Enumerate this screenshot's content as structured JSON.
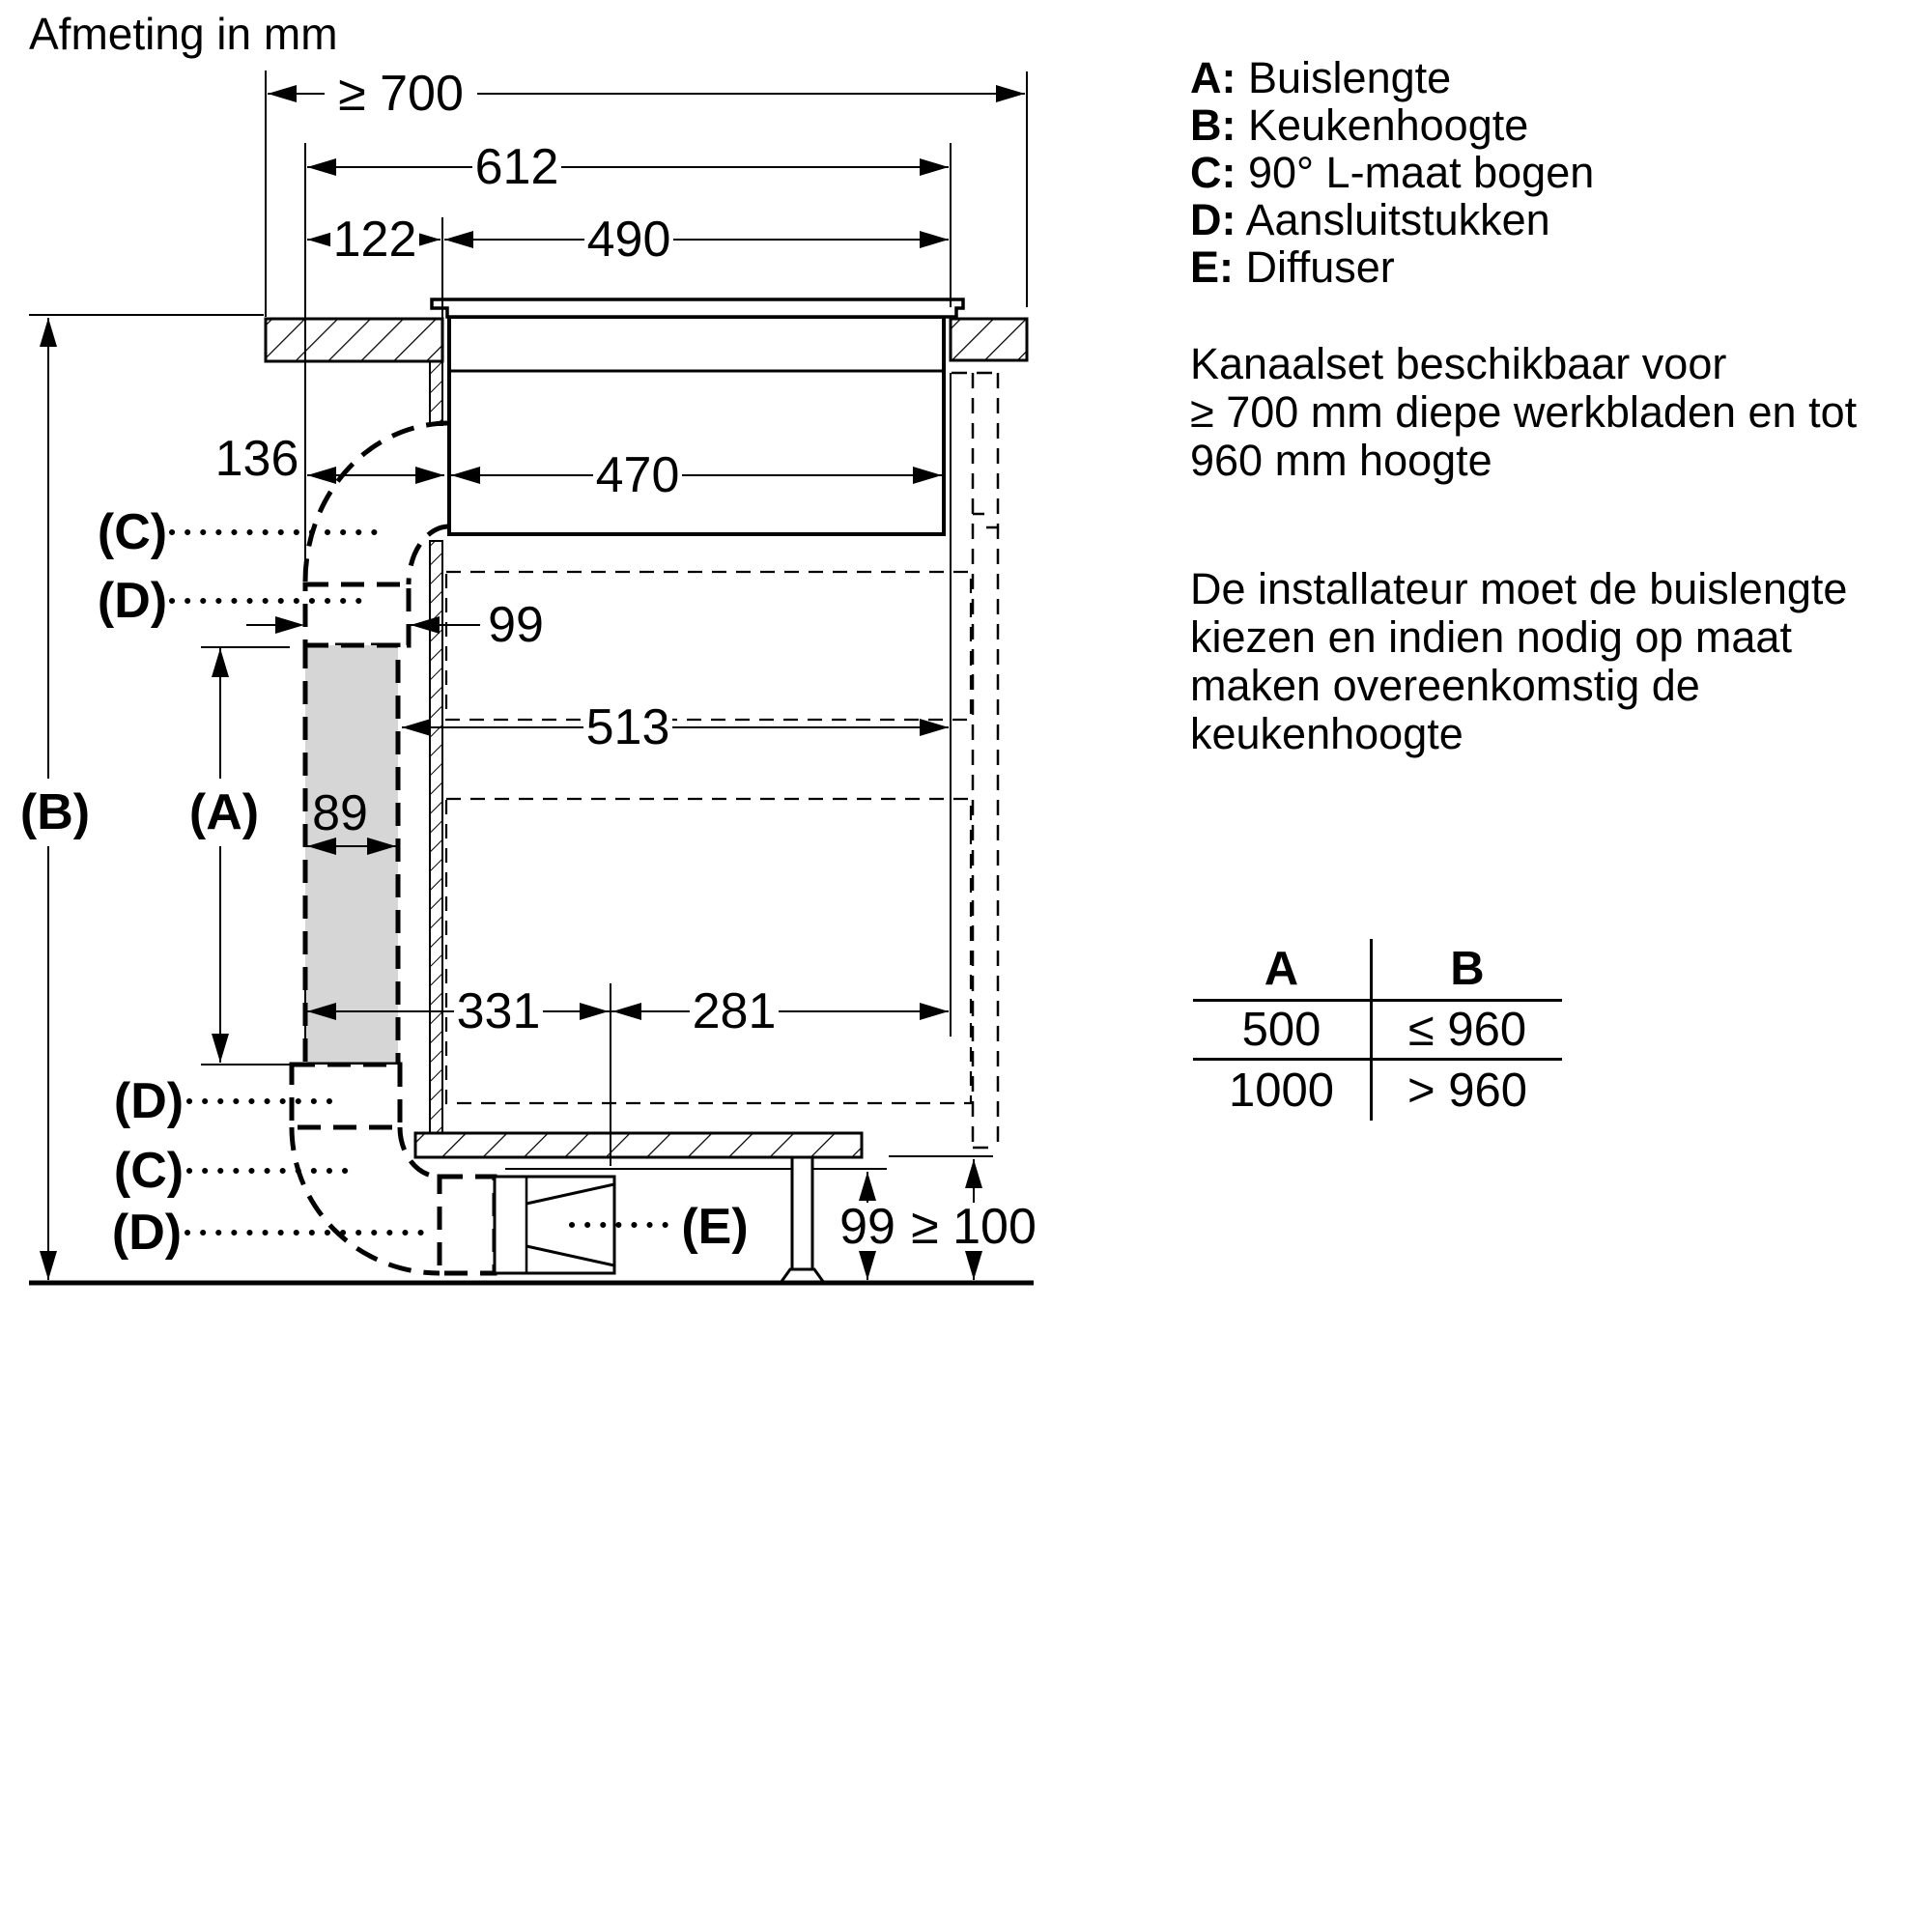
{
  "title": "Afmeting in mm",
  "legend": {
    "items": [
      {
        "key": "A:",
        "label": "Buislengte"
      },
      {
        "key": "B:",
        "label": "Keukenhoogte"
      },
      {
        "key": "C:",
        "label": "90° L-maat bogen"
      },
      {
        "key": "D:",
        "label": "Aansluitstukken"
      },
      {
        "key": "E:",
        "label": "Diffuser"
      }
    ]
  },
  "notes": {
    "availability": [
      "Kanaalset beschikbaar voor",
      "≥ 700 mm diepe werkbladen en tot",
      "960 mm hoogte"
    ],
    "installer": [
      "De installateur moet de buislengte",
      "kiezen en indien nodig op maat",
      "maken overeenkomstig de",
      "keukenhoogte"
    ]
  },
  "table": {
    "header": {
      "a": "A",
      "b": "B"
    },
    "rows": [
      {
        "a": "500",
        "b": "≤ 960"
      },
      {
        "a": "1000",
        "b": "> 960"
      }
    ]
  },
  "dims": {
    "worktop_depth": "≥ 700",
    "hob_width": "612",
    "offset_left": "122",
    "cutout_width": "490",
    "duct_offset": "136",
    "body_width": "470",
    "connector_width": "99",
    "interior_width": "513",
    "duct_width": "89",
    "base_left": "331",
    "base_right": "281",
    "plinth_recess": "99",
    "plinth_height": "≥ 100"
  },
  "labels": {
    "a": "(A)",
    "b": "(B)",
    "c": "(C)",
    "d": "(D)",
    "e": "(E)"
  }
}
